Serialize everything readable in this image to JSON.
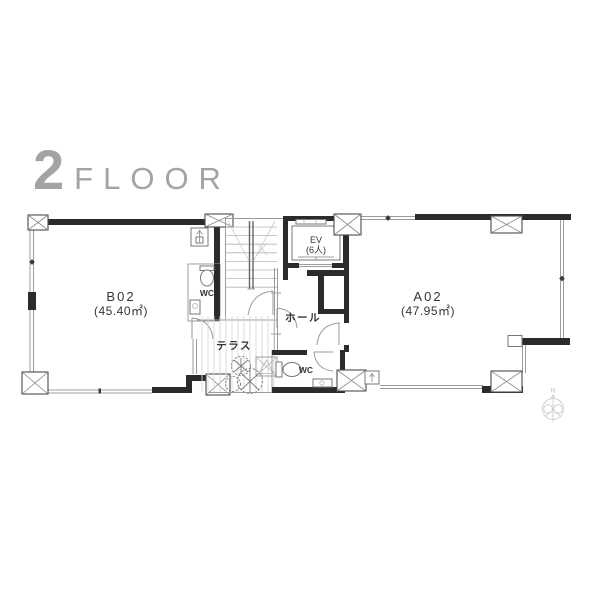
{
  "title": {
    "floor_number": "2",
    "floor_word": "FLOOR"
  },
  "rooms": {
    "b02": {
      "name": "B02",
      "area": "(45.40㎡)"
    },
    "a02": {
      "name": "A02",
      "area": "(47.95㎡)"
    }
  },
  "core": {
    "elevator": {
      "name": "EV",
      "capacity": "(6人)"
    },
    "hall": {
      "name": "ホール"
    },
    "terrace": {
      "name": "テラス"
    },
    "wc_b02": {
      "label": "WC"
    },
    "wc_a02": {
      "label": "WC"
    }
  },
  "compass": {
    "north": "N"
  },
  "colors": {
    "wall": "#2b2b2b",
    "thin_line": "#9c9c9c",
    "terrace_stripe": "#d8d8d8",
    "text": "#353535",
    "title_gray": "#a3a3a3"
  }
}
